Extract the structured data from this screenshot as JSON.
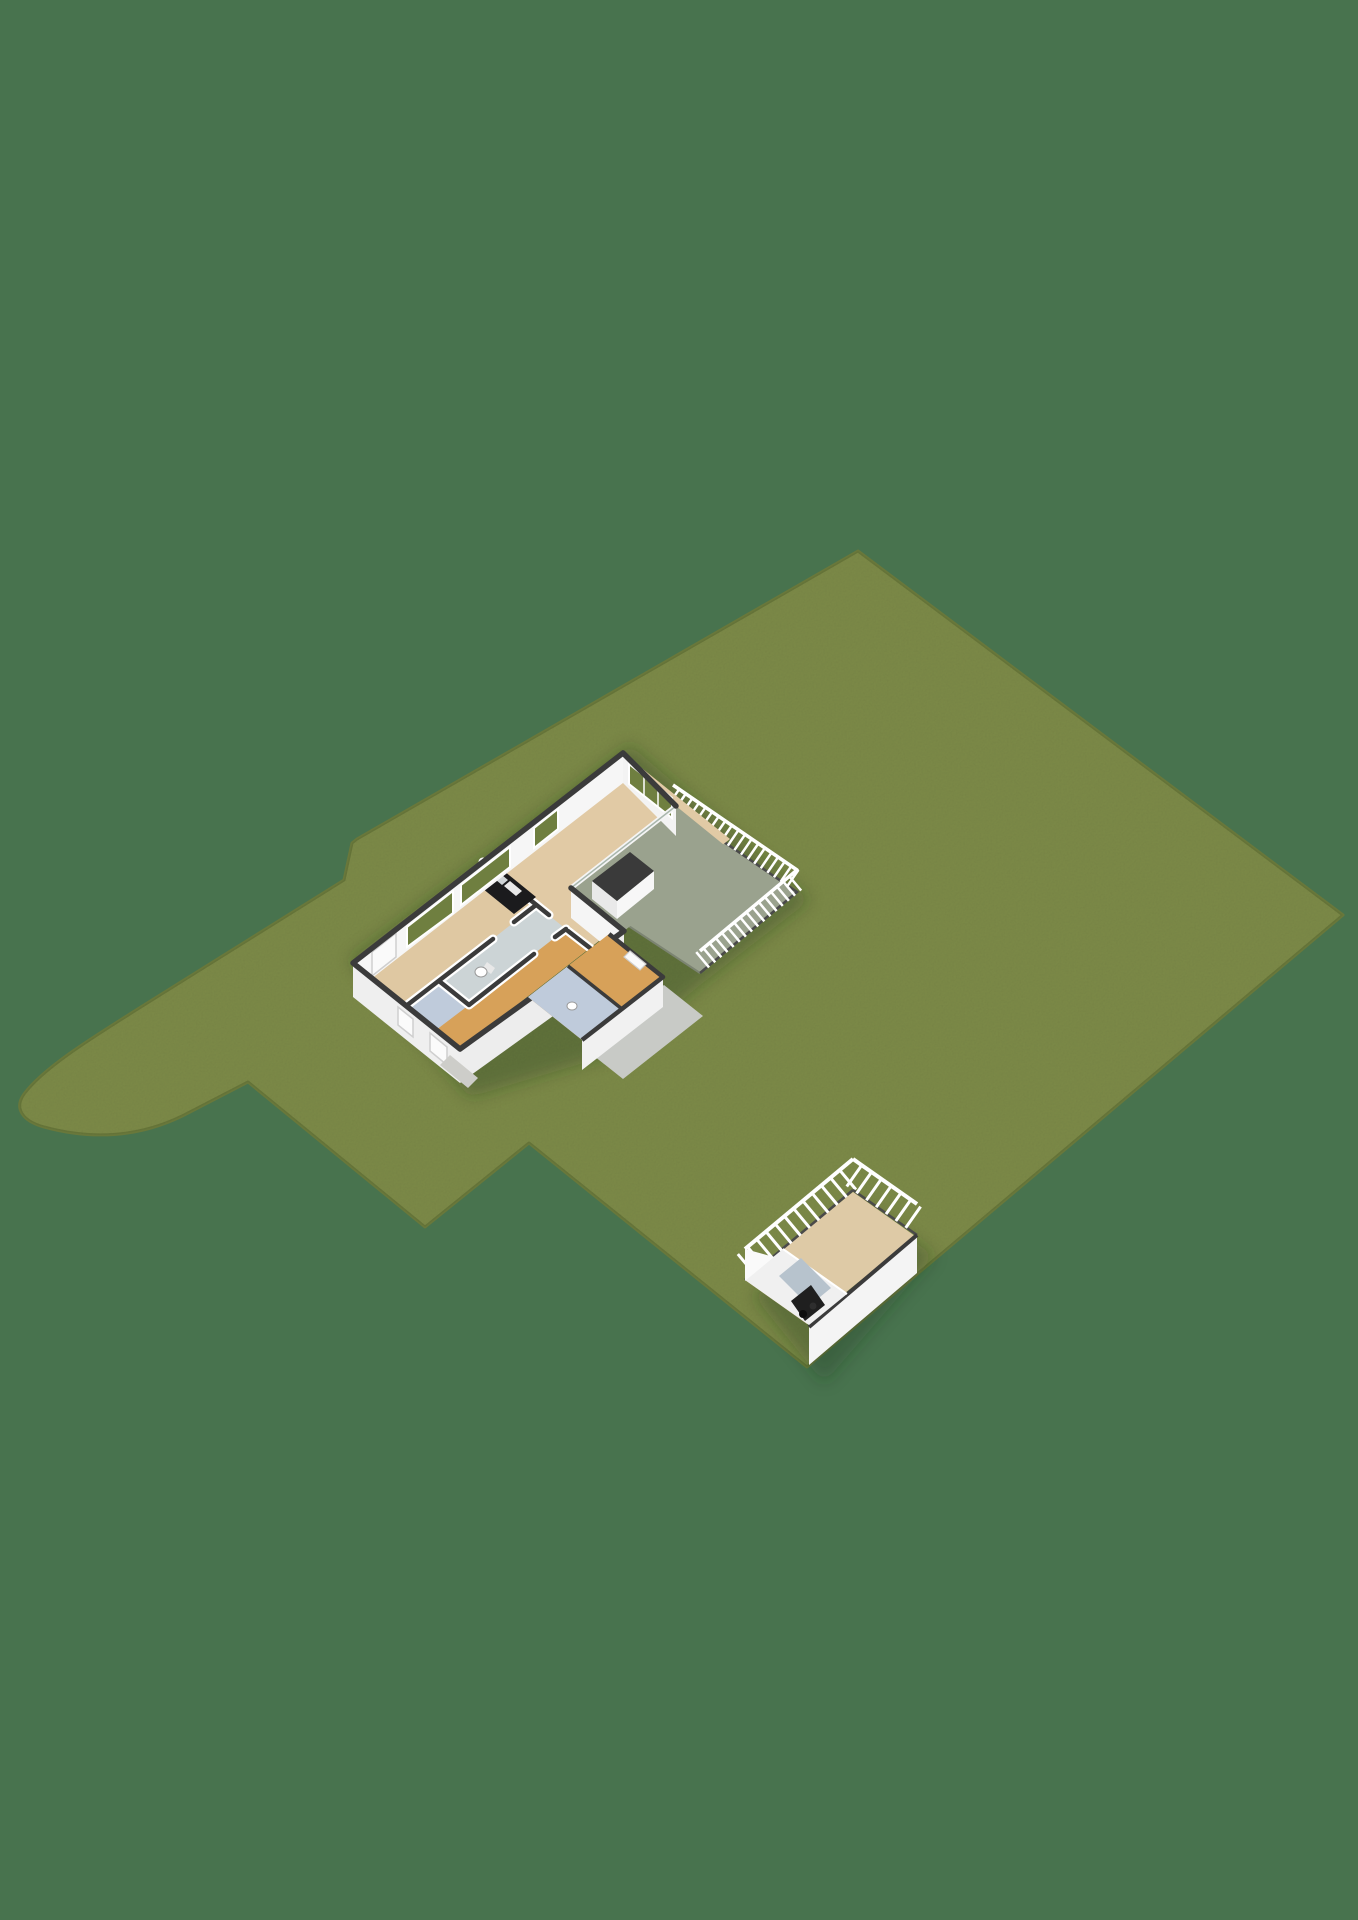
{
  "scene": {
    "kind": "3d-floorplan-site-render",
    "projection": "isometric",
    "objects": {
      "lawn": "garden-parcel",
      "house": "single-storey-house-cutaway",
      "terrace": "raised-terrace-with-railing",
      "garage": "detached-garage-outbuilding"
    }
  },
  "colors": {
    "background": "#48734e",
    "lawn": "#7e8c49",
    "lawn_edge": "#69783b",
    "terrace_floor": "#9aa28e",
    "terrace_edge": "#7c8472",
    "floor_wood": "#e1caa5",
    "floor_bedroom": "#dfc8a2",
    "floor_hall": "#d7a159",
    "floor_bath": "#ccd4d6",
    "floor_bath2": "#bfcbdb",
    "garage_floor": "#decaa6",
    "wall_top": "#3b3b3b",
    "wall_top_soft": "#4a4a4a",
    "wall_white": "#ffffff",
    "wall_inner": "#f6f6f6",
    "wall_inner2": "#f3f3f3",
    "wall_face": "#efefef",
    "wall_face2": "#ededed",
    "wall_face3": "#f4f4f4",
    "wall_face4": "#f1f1f1",
    "wall_face5": "#f5f5f5",
    "chimney_top": "#3a3a3a",
    "chimney_sw": "#e9e9e9",
    "chimney_se": "#f7f7f7",
    "glass_green": "#6f7f40",
    "glass_frame": "#ffffff",
    "glass_sheen": "#a9b7ad",
    "window_blank": "#fbfbfb",
    "window_frame_gray": "#cfcfcf",
    "door_white": "#fafafa",
    "counter_black": "#1b1b1d",
    "counter_obj1": "#cfd4d6",
    "counter_obj2": "#e8e8e8",
    "toilet_white": "#ffffff",
    "toilet_line": "#999999",
    "path_gray": "#c8cac6",
    "stoop_gray": "#cdcdc9",
    "roof_slope": "#f0f0f0",
    "skylight_blue": "#b7c3cd",
    "opening_dark": "#1f1f1f",
    "object_dark1": "#0d0d0d",
    "object_dark2": "#2e2e2e",
    "shadow": "rgba(38,54,27,0.30)"
  }
}
